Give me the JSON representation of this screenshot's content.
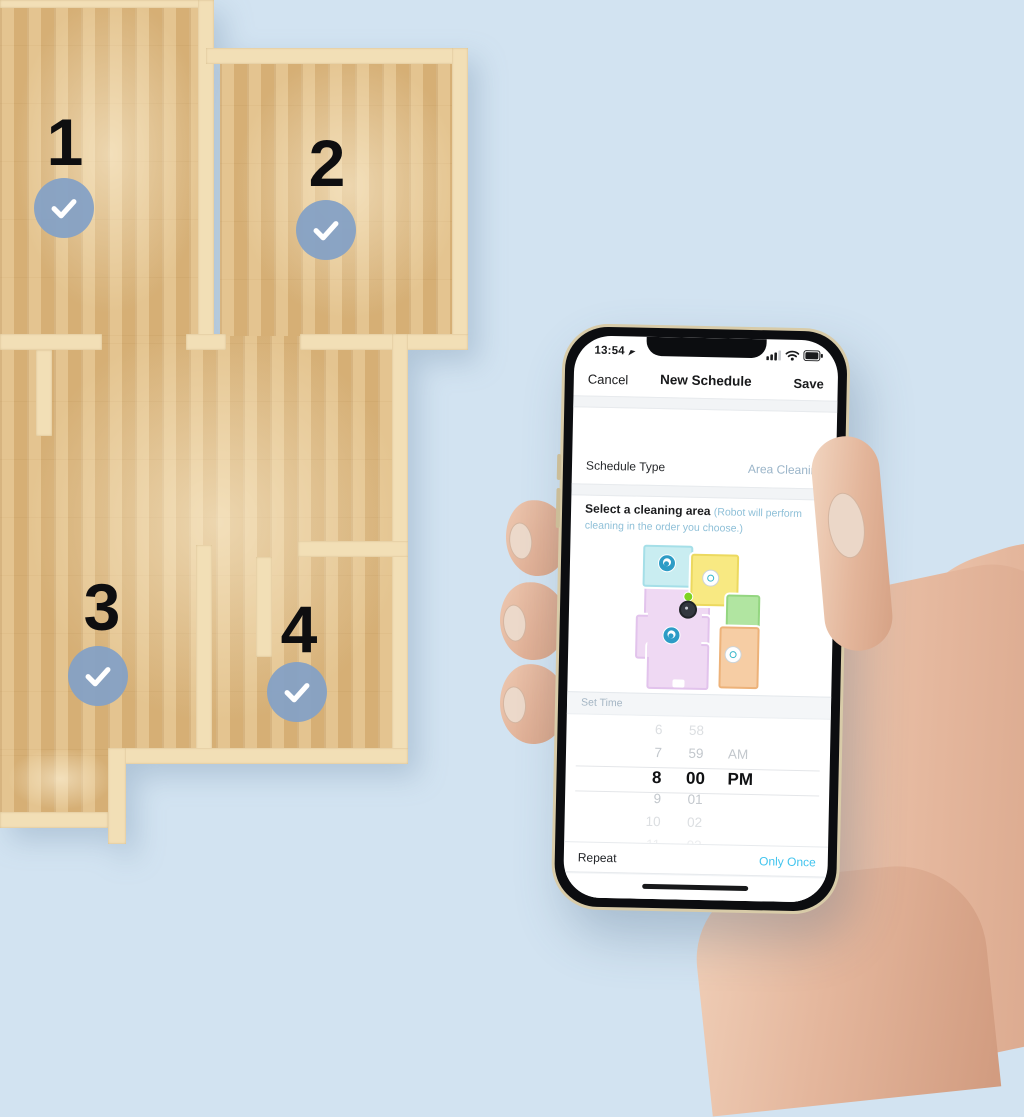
{
  "background_color": "#d2e3f1",
  "floor_plan": {
    "areas": [
      {
        "number": "1",
        "checked": true
      },
      {
        "number": "2",
        "checked": true
      },
      {
        "number": "3",
        "checked": true
      },
      {
        "number": "4",
        "checked": true
      }
    ],
    "colors": {
      "wood": "#ddb981",
      "wall": "#f2dfb6",
      "badge_blue": "#85a1c5"
    }
  },
  "phone": {
    "status_bar": {
      "time": "13:54",
      "icons": [
        "location-arrow",
        "signal",
        "wifi",
        "battery"
      ]
    },
    "nav": {
      "cancel": "Cancel",
      "title": "New Schedule",
      "save": "Save"
    },
    "schedule_type": {
      "label": "Schedule Type",
      "value": "Area Cleaning"
    },
    "select_area": {
      "label": "Select a cleaning area",
      "hint": "(Robot will perform cleaning in the order you choose.)"
    },
    "map": {
      "rooms": [
        {
          "name": "cyan-room",
          "color": "#c9edf1",
          "badge": "order-badge-blue"
        },
        {
          "name": "yellow-room",
          "color": "#f8e982",
          "badge": "select-badge-white"
        },
        {
          "name": "pink-room",
          "color": "#efd9f3",
          "badge": "order-badge-blue"
        },
        {
          "name": "green-room",
          "color": "#b1e5a1",
          "badge": ""
        },
        {
          "name": "orange-room",
          "color": "#f6cda4",
          "badge": "select-badge-white"
        }
      ],
      "robot": "robot-marker"
    },
    "set_time": {
      "label": "Set Time"
    },
    "time_picker": {
      "hours": [
        "5",
        "6",
        "7",
        "8",
        "9",
        "10",
        "11"
      ],
      "minutes": [
        "57",
        "58",
        "59",
        "00",
        "01",
        "02",
        "03"
      ],
      "period_rows": [
        "",
        "",
        "AM",
        "PM",
        "",
        "",
        ""
      ],
      "selected": {
        "hour": "8",
        "minute": "00",
        "period": "PM"
      }
    },
    "repeat": {
      "label": "Repeat",
      "value": "Only Once"
    },
    "accent_colors": {
      "value_teal": "#9bb5c9",
      "hint_teal": "#8fc0d8",
      "link_cyan": "#41c4ee"
    }
  }
}
